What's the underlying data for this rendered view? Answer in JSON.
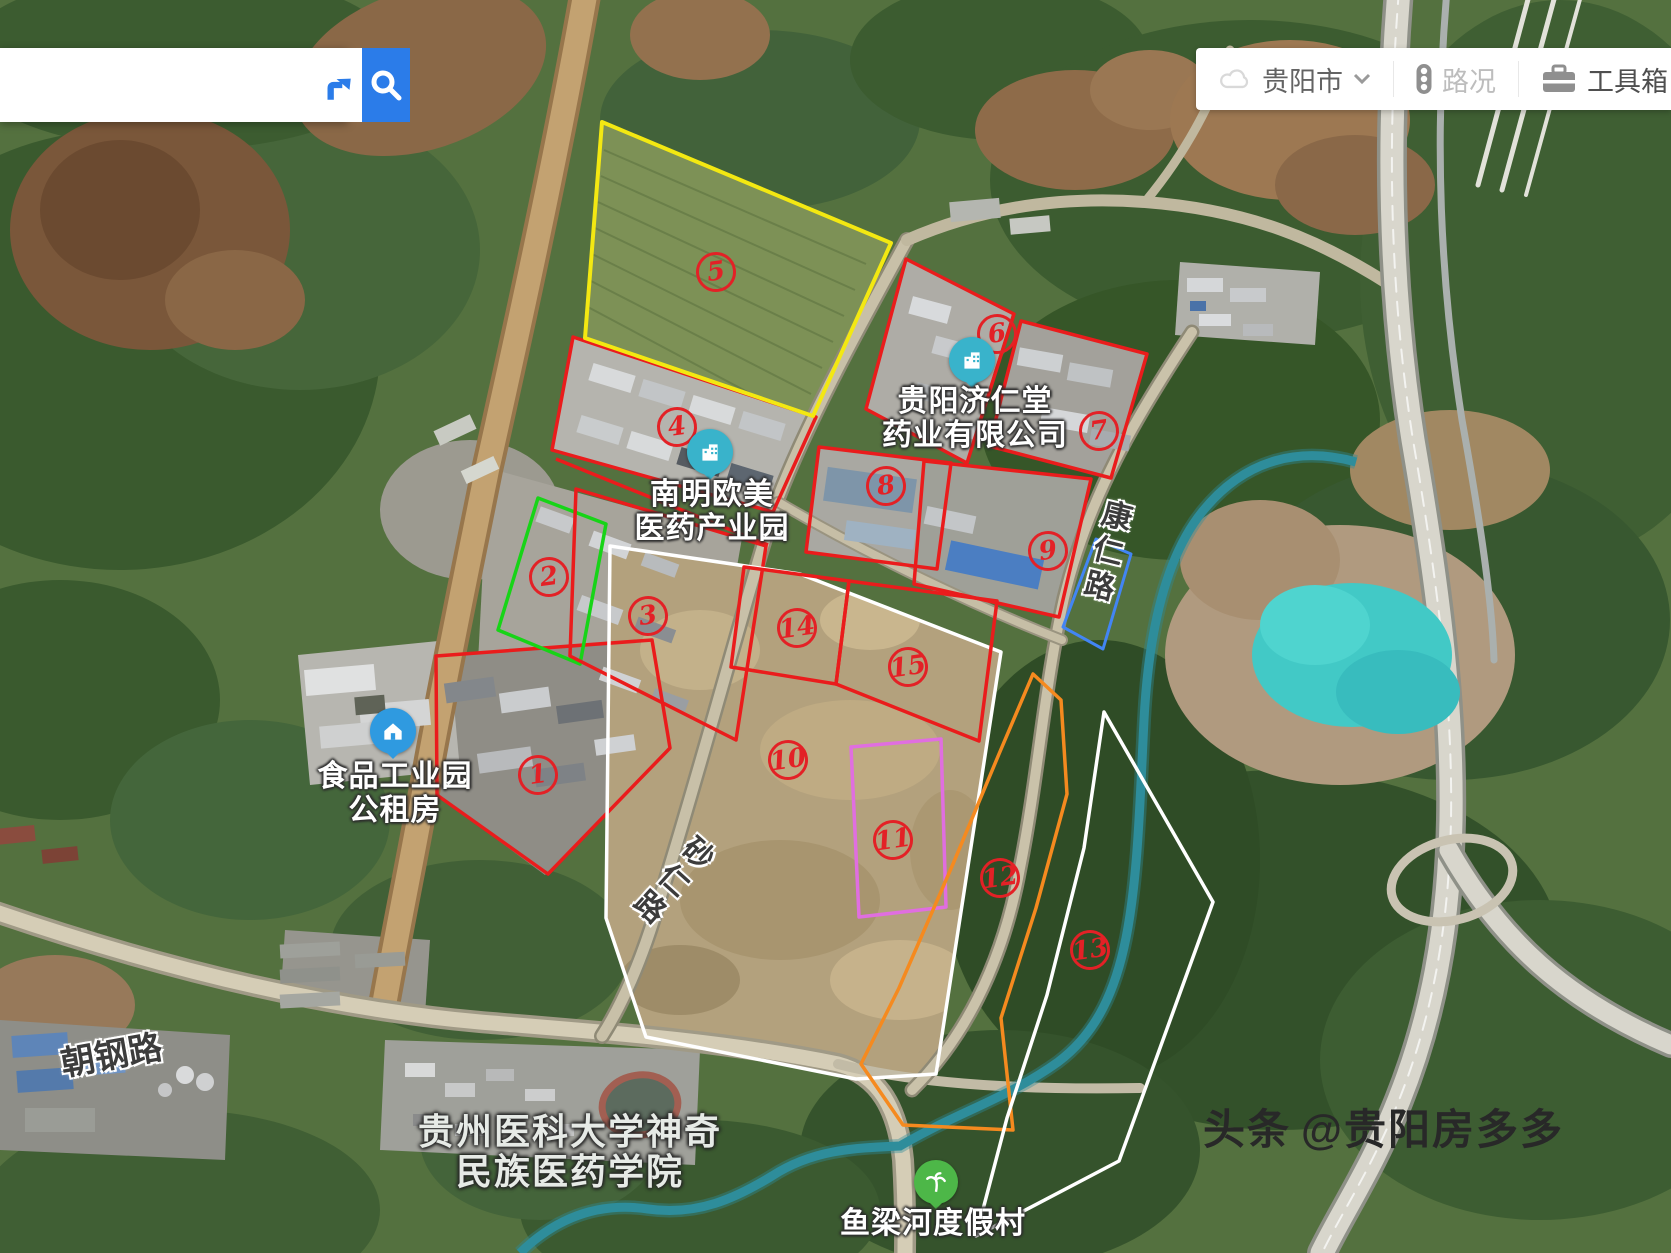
{
  "map": {
    "search": {
      "value": "",
      "placeholder": ""
    },
    "city_selector": "贵阳市",
    "traffic_label": "路况",
    "toolbox_label": "工具箱"
  },
  "pois": {
    "jirentang": {
      "line1": "贵阳济仁堂",
      "line2": "药业有限公司",
      "color": "#39b3cb"
    },
    "oumei": {
      "line1": "南明欧美",
      "line2": "医药产业园",
      "color": "#39b3cb"
    },
    "shipin": {
      "line1": "食品工业园",
      "line2": "公租房",
      "color": "#2f9ae0"
    },
    "yuliang": {
      "name": "鱼梁河度假村",
      "color": "#4db748"
    },
    "university": {
      "line1": "贵州医科大学神奇",
      "line2": "民族医药学院"
    }
  },
  "roads": {
    "chaogang": "朝钢路",
    "shaling": "砂仁路",
    "kangren": "康仁路"
  },
  "regions": [
    {
      "number": "1",
      "color": "#ea1c1c"
    },
    {
      "number": "2",
      "color": "#17d417"
    },
    {
      "number": "3",
      "color": "#ea1c1c"
    },
    {
      "number": "4",
      "color": "#ea1c1c"
    },
    {
      "number": "5",
      "color": "#f3e812"
    },
    {
      "number": "6",
      "color": "#ea1c1c"
    },
    {
      "number": "7",
      "color": "#ea1c1c"
    },
    {
      "number": "8",
      "color": "#ea1c1c"
    },
    {
      "number": "9",
      "color": "#ea1c1c"
    },
    {
      "number": "10",
      "color": "#ffffff"
    },
    {
      "number": "11",
      "color": "#e06ee0"
    },
    {
      "number": "12",
      "color": "#f58a1f"
    },
    {
      "number": "13",
      "color": "#ffffff"
    },
    {
      "number": "14",
      "color": "#ea1c1c"
    },
    {
      "number": "15",
      "color": "#ea1c1c"
    }
  ],
  "extra_shapes": {
    "blue_plot": "#4285f4"
  },
  "watermark": {
    "brand": "头条",
    "handle": "@贵阳房多多"
  }
}
